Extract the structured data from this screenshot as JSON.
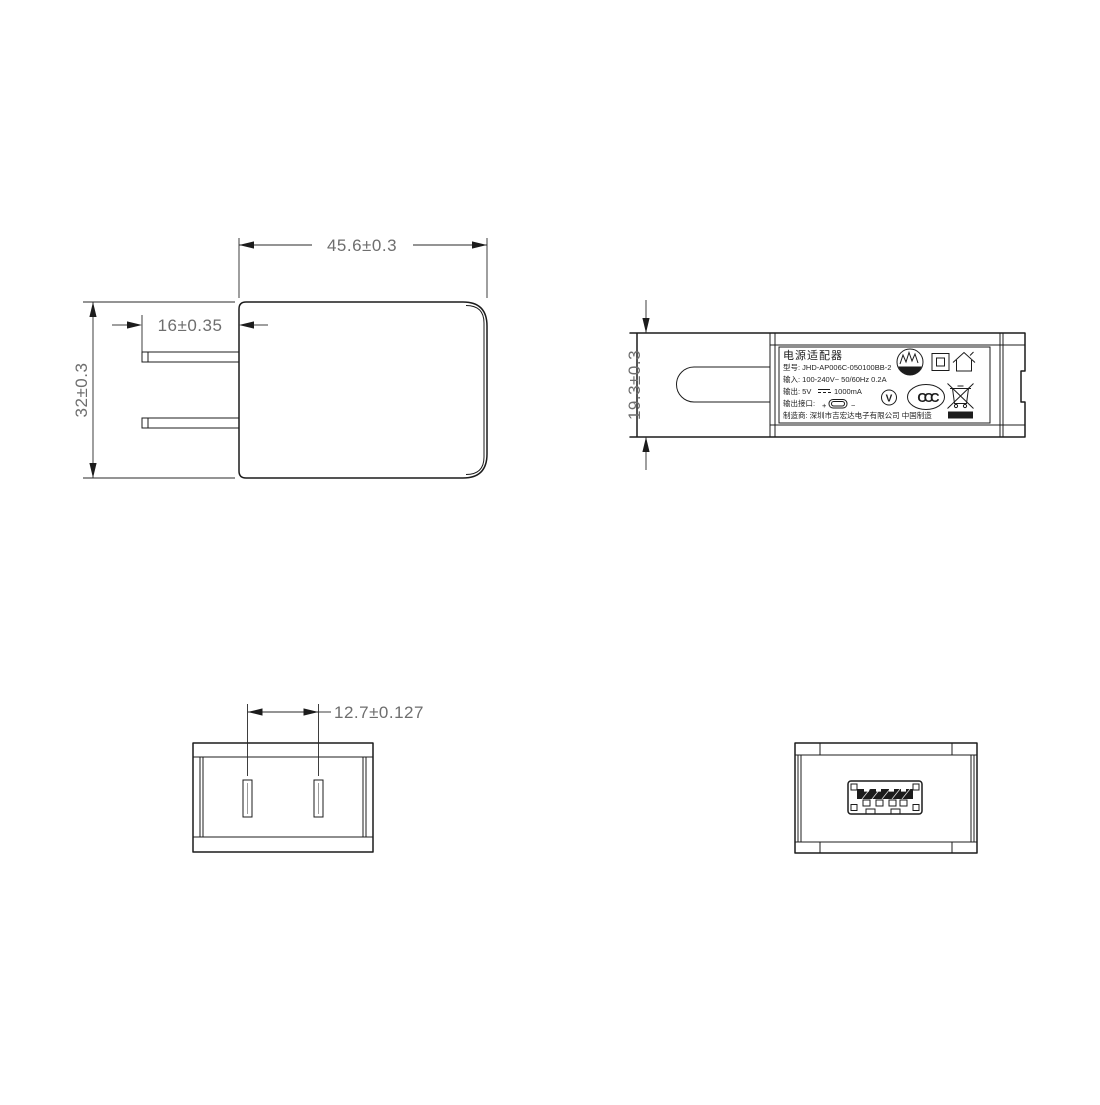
{
  "document_type": "power-adapter-technical-drawing",
  "colors": {
    "background": "#ffffff",
    "line": "#1c1c1c",
    "dim_text": "#6e6e6e"
  },
  "views": {
    "front": {
      "dim_width": "45.6±0.3",
      "dim_prong_length": "16±0.35",
      "dim_height": "32±0.3"
    },
    "side": {
      "dim_thickness": "19.3±0.3",
      "label": {
        "title": "电源适配器",
        "model": "型号: JHD-AP006C-050100BB-2",
        "input": "输入: 100-240V~  50/60Hz  0.2A",
        "output_prefix": "输出: 5V",
        "output_current": "1000mA",
        "port_label": "输出接口:",
        "port_plus": "+",
        "port_minus": "−",
        "manufacturer": "制造商: 深圳市吉宏达电子有限公司   中国制造",
        "efficiency_level": "V",
        "ccc_text": "CCC"
      }
    },
    "top": {
      "dim_prong_spacing": "12.7±0.127"
    }
  },
  "icons": {
    "certification_circle": "circle-with-zigzag-band",
    "class_ii": "double-square",
    "indoor_use_only": "house-outline",
    "efficiency_mark": "circled-V",
    "ccc_mark": "oval-CCC",
    "weee": "crossed-out-wheelie-bin",
    "dc_symbol": "solid-line-over-dashed-line",
    "usb_connector": "rounded-rect-connector"
  }
}
